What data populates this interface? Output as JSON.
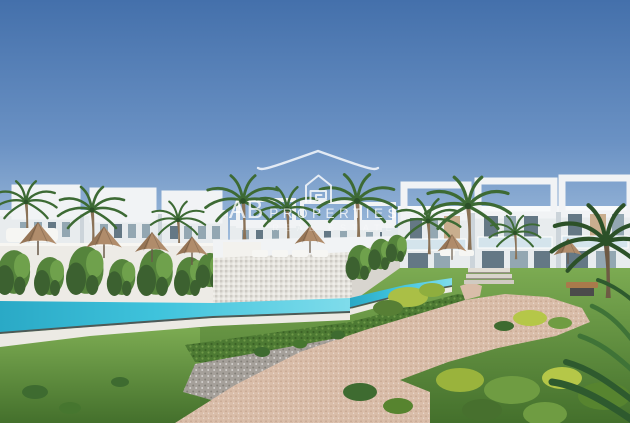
{
  "meta": {
    "kind": "architectural-render-photo",
    "description": "3D render of a white modern residential complex with rooftop pergolas, palm trees, tan parasols, an infinity pool with ivy-covered walls, green lawns, shrubs and a winding gravel path under a clear blue sky, overlaid with a translucent real-estate watermark."
  },
  "watermark": {
    "brand_prefix": "AB",
    "brand_name": "PROPERTIES",
    "tagline": "REAL ESTATE",
    "icons": {
      "roof": "roof-outline-icon",
      "house": "house-spiral-icon"
    },
    "color": "#ffffff"
  },
  "scene": {
    "elements": [
      "sky",
      "building-cluster-left",
      "building-cluster-center",
      "building-cluster-right",
      "palm-trees",
      "parasols",
      "ivy-wall",
      "planter-platform",
      "swimming-pool",
      "pool-coping",
      "lawn",
      "hedge-strip",
      "gravel-bed",
      "garden-path",
      "garden-steps",
      "bush-clusters",
      "garden-bench",
      "corner-palm-fronds"
    ],
    "colors": {
      "sky_top": "#4470ab",
      "sky_mid": "#6b92c4",
      "sky_horizon": "#a9c4e0",
      "building_white": "#f1f3f5",
      "building_face": "#e8ecee",
      "building_shade": "#ccd4da",
      "window_dark": "#647885",
      "window_mid": "#93a7b2",
      "wood_slat": "#c9ae8e",
      "rail_glass": "#d4e4ec",
      "pool_deep": "#2aa9c6",
      "pool_water": "#3fc3dc",
      "pool_light": "#7fdceb",
      "pool_coping": "#eceae4",
      "pool_edge_dark": "#4d5a57",
      "wall_white": "#edebe6",
      "platform_face": "#e5e3dd",
      "ivy_dark": "#3c6130",
      "ivy_mid": "#55843c",
      "ivy_light": "#6fa14c",
      "hedge_green": "#4d7a33",
      "lawn_light": "#7cab52",
      "lawn_dark": "#44702c",
      "gravel_gray": "#a5a09a",
      "path_beige": "#d9bda9",
      "path_light": "#e8d2bf",
      "umbrella_tan": "#b08c6b",
      "umbrella_pole": "#6b5b4a",
      "palm_green": "#3d6a34",
      "palm_dark": "#2c5128",
      "palm_trunk": "#8a7257",
      "bench_wood": "#a97a4b",
      "bench_dark": "#4b4b4b",
      "watermark_white": "#ffffff"
    }
  }
}
